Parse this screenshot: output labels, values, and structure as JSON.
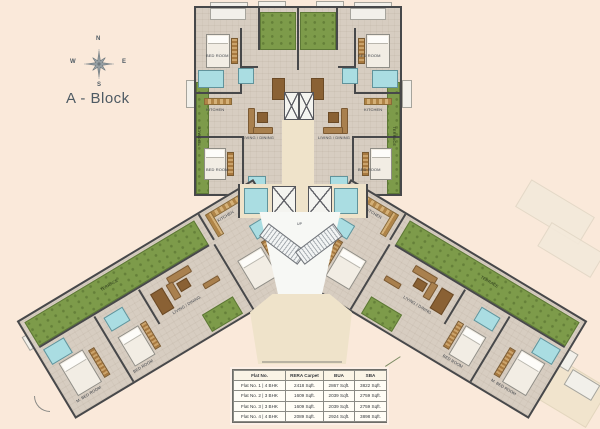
{
  "title": "A - Block",
  "compass": {
    "north": "N",
    "south": "S",
    "east": "E",
    "west": "W"
  },
  "colors": {
    "background": "#fae9da",
    "floor": "#d7cdc1",
    "wall": "#47484a",
    "green": "#7d9b4a",
    "water": "#aadde2",
    "lobby": "#efe3ca",
    "accent_text": "#4e5a63"
  },
  "labels": {
    "bed_room": "BED ROOM",
    "m_bed_room": "M. BED ROOM",
    "living_dining": "LIVING / DINING",
    "kitchen": "KITCHEN",
    "toilet": "TOIL.",
    "lift_1": "LIFT-01",
    "lift_2": "LIFT-02",
    "up": "UP",
    "terrace": "TERRACE"
  },
  "area_table": {
    "headers": [
      "Flat No.",
      "RERA Carpet",
      "BUA",
      "SBA"
    ],
    "rows": [
      [
        "Flat No. 1 | 4 BHK",
        "2418 Sqft.",
        "2867 Sqft.",
        "3822 Sqft."
      ],
      [
        "Flat No. 2 | 3 BHK",
        "1609 Sqft.",
        "2039 Sqft.",
        "2759 Sqft."
      ],
      [
        "Flat No. 3 | 3 BHK",
        "1609 Sqft.",
        "2039 Sqft.",
        "2759 Sqft."
      ],
      [
        "Flat No. 4 | 4 BHK",
        "2089 Sqft.",
        "2924 Sqft.",
        "3898 Sqft."
      ]
    ]
  }
}
